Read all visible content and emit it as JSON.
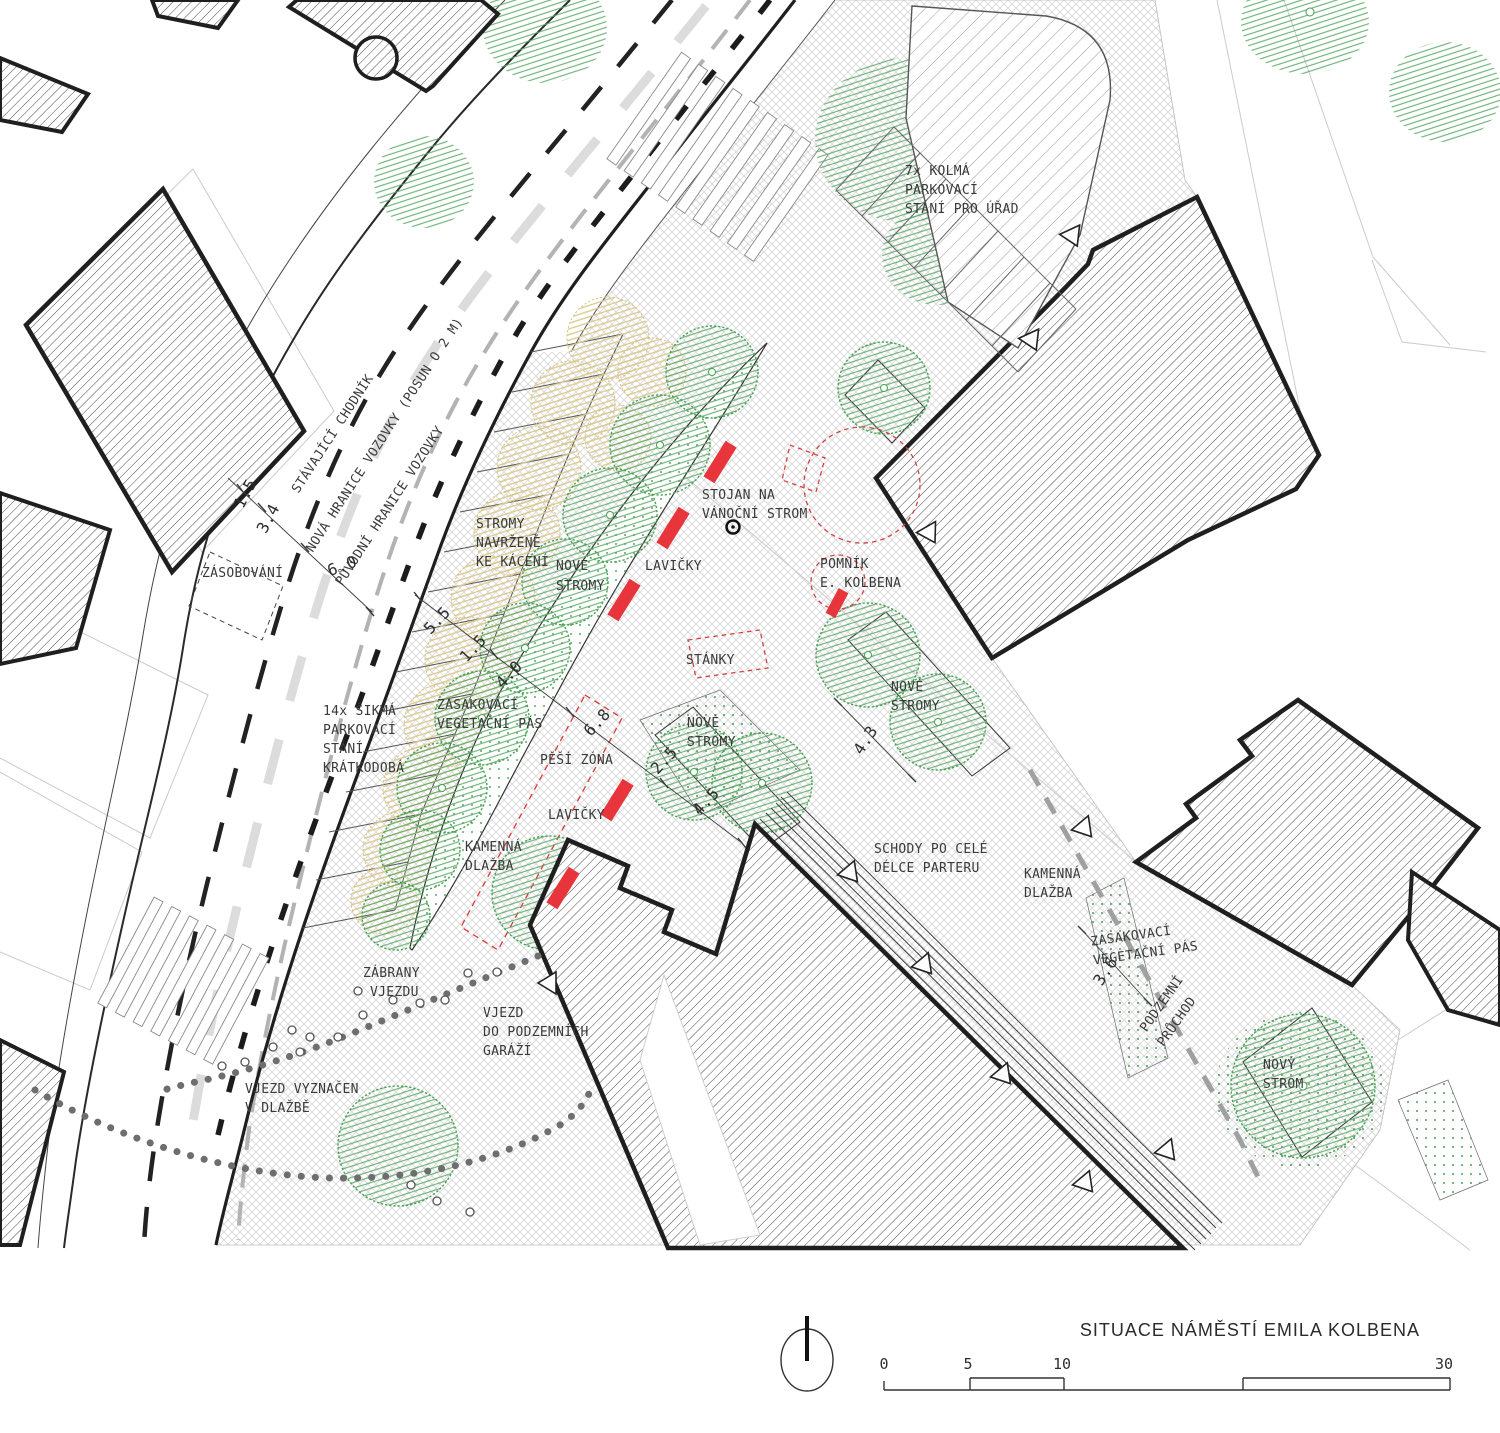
{
  "title": "SITUACE NÁMĚSTÍ EMILA KOLBENA",
  "scalebar": {
    "t0": "0",
    "t5": "5",
    "t10": "10",
    "t30": "30"
  },
  "road_labels": {
    "sidewalk": "STÁVAJÍCÍ CHODNÍK",
    "new_boundary": "NOVÁ HRANICE VOZOVKY (POSUN O 2 M)",
    "old_boundary": "PŮVODNÍ HRANICE VOZOVKY"
  },
  "labels": {
    "zasobovani": "ZÁSOBOVÁNÍ",
    "stromy_kaceni": [
      "STROMY",
      "NAVRŽENÉ",
      "KE KÁCENÍ"
    ],
    "nove_stromy_1": [
      "NOVÉ",
      "STROMY"
    ],
    "lavicky_1": "LAVIČKY",
    "stojan": [
      "STOJAN NA",
      "VÁNOČNÍ STROM"
    ],
    "pomnik": [
      "POMNÍK",
      "E. KOLBENA"
    ],
    "stanky": "STÁNKY",
    "nove_stromy_2": [
      "NOVÉ",
      "STROMY"
    ],
    "nove_stromy_3": [
      "NOVÉ",
      "STROMY"
    ],
    "parking_7": [
      "7x KOLMÁ",
      "PARKOVACÍ",
      "STÁNÍ PRO ÚŘAD"
    ],
    "parking_14": [
      "14x ŠIKMÁ",
      "PARKOVACÍ",
      "STÁNÍ",
      "KRÁTKODOBÁ"
    ],
    "zasakovaci_1": [
      "ZASAKOVACÍ",
      "VEGETAČNÍ PÁS"
    ],
    "pesi_zona": "PĚŠÍ ZÓNA",
    "lavicky_2": "LAVIČKY",
    "kamenna_1": [
      "KAMENNÁ",
      "DLAŽBA"
    ],
    "zabrany": [
      "ZÁBRANY",
      "VJEZDU"
    ],
    "vjezd_garaze": [
      "VJEZD",
      "DO PODZEMNÍCH",
      "GARÁŽÍ"
    ],
    "vjezd_dlazba": [
      "VJEZD VYZNAČEN",
      "V DLAŽBĚ"
    ],
    "schody": [
      "SCHODY PO CELÉ",
      "DÉLCE PARTERU"
    ],
    "kamenna_2": [
      "KAMENNÁ",
      "DLAŽBA"
    ],
    "zasakovaci_2": [
      "ZASAKOVACÍ",
      "VEGETAČNÍ PÁS"
    ],
    "podzemni": [
      "PODZEMNÍ",
      "PRŮCHOD"
    ],
    "novy_strom": [
      "NOVÝ",
      "STROM"
    ]
  },
  "dimensions": {
    "a": "1.5",
    "b": "3.4",
    "c": "6.0",
    "d": "5.5",
    "e": "1.5",
    "f": "4.0",
    "g": "6.8",
    "h": "2.5",
    "i": "4.5",
    "j": "4.3",
    "k": "3.6"
  },
  "colors": {
    "tree_green": "#4aa356",
    "felled_yellow": "#dbc88c",
    "bench_red": "#e8353c",
    "building_line": "#1f1f1f",
    "paving_line": "#cecece"
  }
}
